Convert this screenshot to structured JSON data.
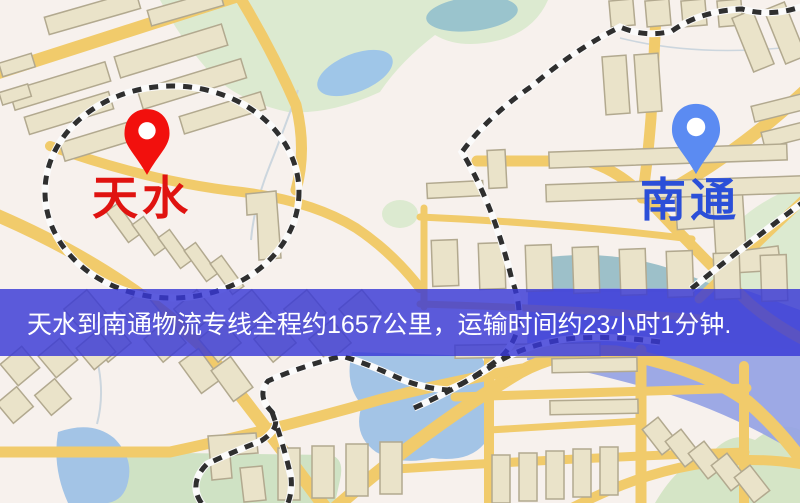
{
  "banner": {
    "text": "天水到南通物流专线全程约1657公里，运输时间约23小时1分钟.",
    "overlay_color": "rgba(56,56,214,0.82)",
    "text_color": "#ffffff"
  },
  "route": {
    "origin": "天水",
    "destination": "南通",
    "distance_text": "约1657公里",
    "duration_text": "约23小时1分钟"
  },
  "markers": {
    "origin": {
      "label": "天水",
      "pin_color": "#f2100d",
      "label_color": "#e01310"
    },
    "destination": {
      "label": "南通",
      "pin_color": "#5b8bf2",
      "label_color": "#2b4fd8"
    }
  },
  "map": {
    "palette": {
      "land": "#f7f1ed",
      "road": "#f1cb6b",
      "building_fill": "#eae3c9",
      "building_edge": "#b2a98f",
      "park_green": "#dcead0",
      "field_green": "#cfe2c4",
      "water_blue": "#a3c4e6",
      "pond_teal": "#9ac4cd",
      "river_violet": "#95a3e4",
      "railway_dark": "#2f2f2f",
      "railway_light": "#fbfbfb"
    }
  }
}
